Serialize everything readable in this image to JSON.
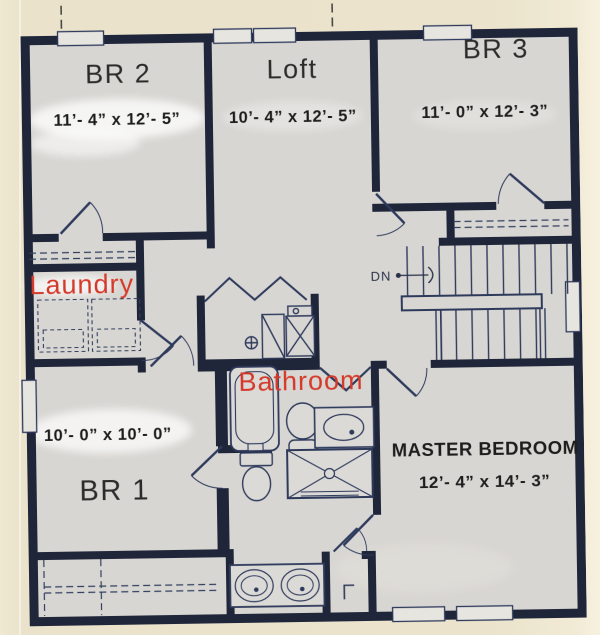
{
  "colors": {
    "paper": "#ebe3cb",
    "floor": "#d8d6d2",
    "wall": "#20263a",
    "fixture_line": "#32405f",
    "red_label": "#d5392a",
    "text": "#262626"
  },
  "rooms": {
    "br2": {
      "label": "BR 2",
      "dimensions": "11’- 4” x 12’- 5”"
    },
    "loft": {
      "label": "Loft",
      "dimensions": "10’- 4” x 12’- 5”"
    },
    "br3": {
      "label": "BR 3",
      "dimensions": "11’- 0” x 12’- 3”"
    },
    "laundry": {
      "label": "Laundry"
    },
    "bathroom": {
      "label": "Bathroom"
    },
    "br1": {
      "label": "BR 1",
      "dimensions": "10’- 0” x 10’- 0”"
    },
    "master_bedroom": {
      "label": "MASTER BEDROOM",
      "dimensions": "12’- 4” x 14’- 3”"
    }
  },
  "stairs": {
    "down_label": "DN"
  }
}
